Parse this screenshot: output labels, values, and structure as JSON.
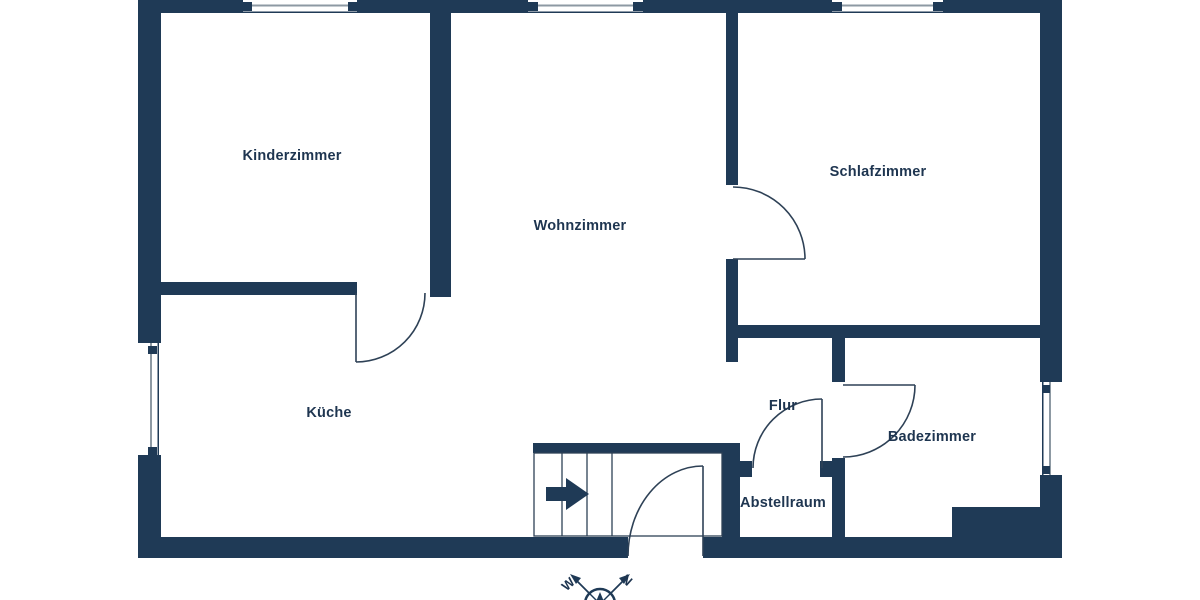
{
  "floor_plan": {
    "rooms": [
      {
        "id": "kinderzimmer",
        "label": "Kinderzimmer"
      },
      {
        "id": "wohnzimmer",
        "label": "Wohnzimmer"
      },
      {
        "id": "schlafzimmer",
        "label": "Schlafzimmer"
      },
      {
        "id": "kueche",
        "label": "Küche"
      },
      {
        "id": "flur",
        "label": "Flur"
      },
      {
        "id": "badezimmer",
        "label": "Badezimmer"
      },
      {
        "id": "abstellraum",
        "label": "Abstellraum"
      }
    ],
    "compass": {
      "west_label": "W",
      "north_label": "N"
    },
    "colors": {
      "wall": "#1f3a56",
      "label_text": "#1e3550",
      "window_line": "#8d99a3",
      "door_line": "#2e4156",
      "background": "#ffffff"
    }
  }
}
